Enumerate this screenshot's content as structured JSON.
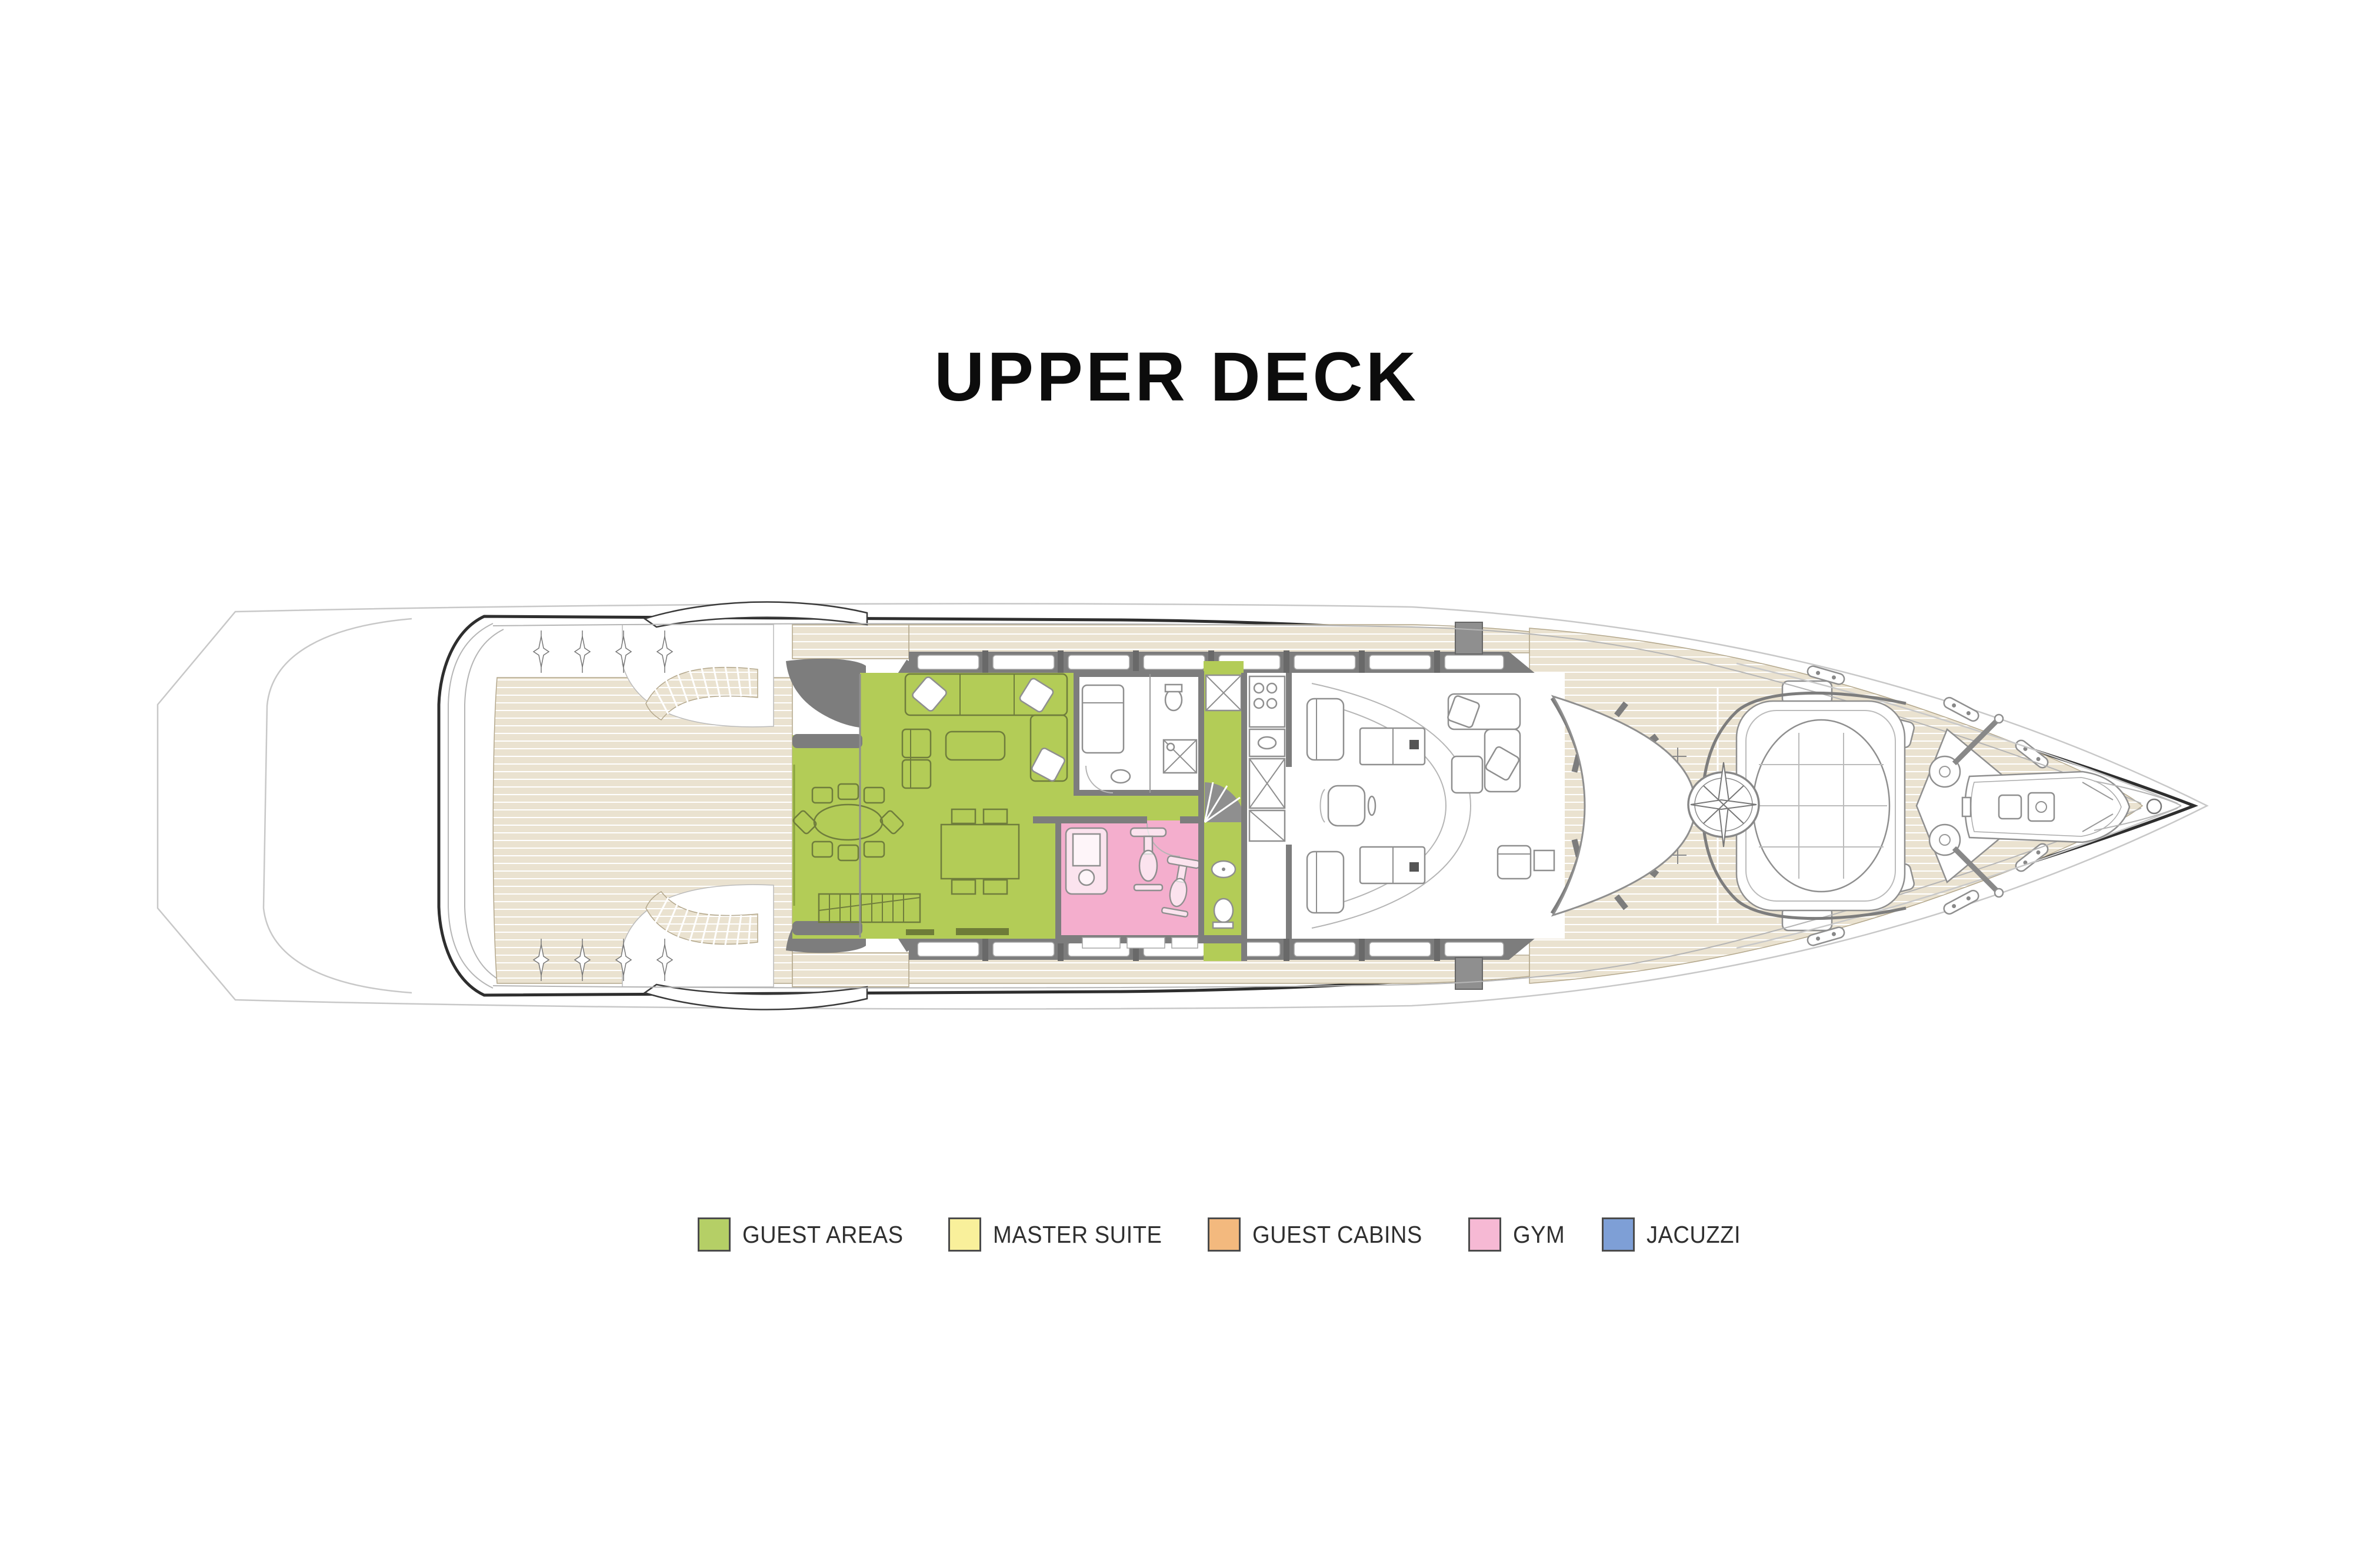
{
  "title": "UPPER DECK",
  "legend": [
    {
      "id": "guest-areas",
      "label": "GUEST AREAS",
      "color": "#b5cf66"
    },
    {
      "id": "master-suite",
      "label": "MASTER SUITE",
      "color": "#f9f09b"
    },
    {
      "id": "guest-cabins",
      "label": "GUEST CABINS",
      "color": "#f3b97e"
    },
    {
      "id": "gym",
      "label": "GYM",
      "color": "#f6b9d4"
    },
    {
      "id": "jacuzzi",
      "label": "JACUZZI",
      "color": "#7e9fd6"
    }
  ],
  "plan": {
    "colors": {
      "teak": "#eae2d0",
      "plank_line": "#ffffff",
      "outline": "#2e2e2e",
      "faint": "#c8c8c8",
      "wall": "#7d7d7d",
      "guest_areas": "#b3cc57",
      "gym": "#f4aecd",
      "furniture": "#8f8f8f"
    },
    "highlighted_areas": [
      {
        "name": "sky-lounge-salon",
        "category": "guest-areas"
      },
      {
        "name": "alfresco-dining",
        "category": "guest-areas"
      },
      {
        "name": "service-corridor",
        "category": "guest-areas"
      },
      {
        "name": "gym-room",
        "category": "gym"
      }
    ],
    "drawing_features": [
      "aft-teak-deck",
      "port-curved-stair",
      "starboard-curved-stair",
      "deck-light-markers",
      "superstructure-windows",
      "wheelhouse",
      "helm-station",
      "windshield",
      "observation-lounge",
      "sun-pad",
      "compass-rose",
      "anchor-winch-platform",
      "tender-boat",
      "foredeck",
      "bow-cleats",
      "deck-hatches"
    ]
  }
}
